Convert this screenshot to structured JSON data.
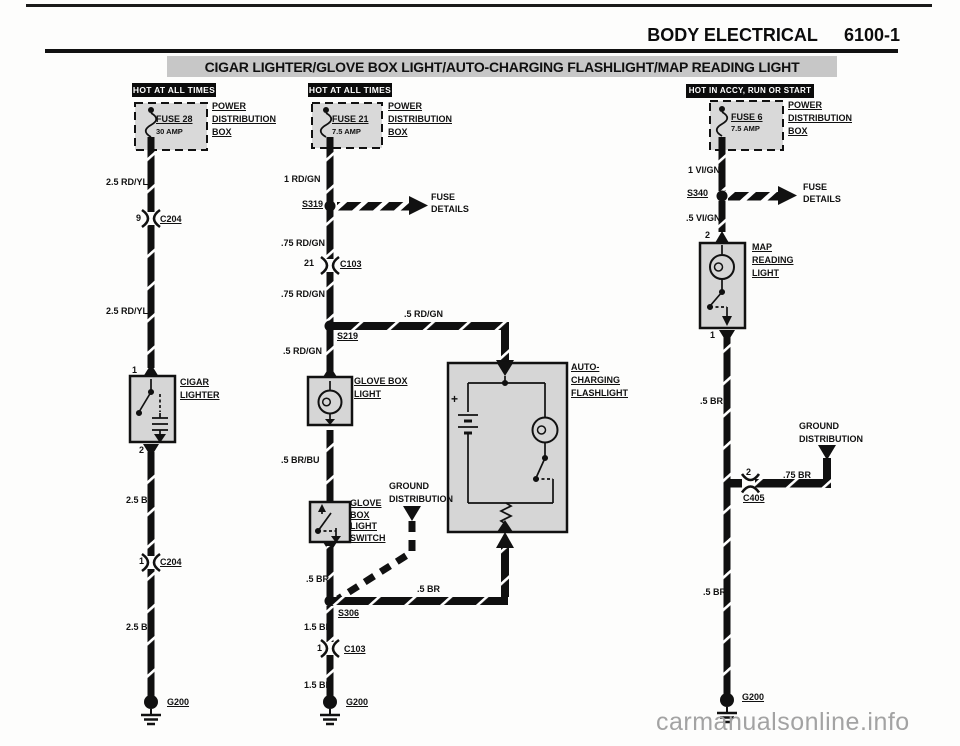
{
  "header": {
    "section": "BODY ELECTRICAL",
    "page": "6100-1"
  },
  "title": "CIGAR LIGHTER/GLOVE BOX LIGHT/AUTO-CHARGING FLASHLIGHT/MAP READING LIGHT",
  "watermark": "carmanualsonline.info",
  "shared": {
    "power_box": [
      "POWER",
      "DISTRIBUTION",
      "BOX"
    ],
    "fuse_details": [
      "FUSE",
      "DETAILS"
    ],
    "ground_distribution": [
      "GROUND",
      "DISTRIBUTION"
    ]
  },
  "col1": {
    "badge": "HOT AT ALL TIMES",
    "fuse_name": "FUSE 28",
    "fuse_rating": "30 AMP",
    "w1": "2.5 RD/YL",
    "c1_pin": "9",
    "c1": "C204",
    "w2": "2.5 RD/YL",
    "pin_top": "1",
    "component": [
      "CIGAR",
      "LIGHTER"
    ],
    "pin_bottom": "2",
    "w3": "2.5 BR",
    "c2_pin": "1",
    "c2": "C204",
    "w4": "2.5 BR",
    "ground": "G200"
  },
  "col2": {
    "badge": "HOT AT ALL TIMES",
    "fuse_name": "FUSE 21",
    "fuse_rating": "7.5 AMP",
    "w1": "1 RD/GN",
    "splice1": "S319",
    "w2": ".75 RD/GN",
    "c1_pin": "21",
    "c1": "C103",
    "w3": ".75 RD/GN",
    "branch_wire": ".5 RD/GN",
    "splice2": "S219",
    "w4": ".5 RD/GN",
    "light": [
      "GLOVE BOX",
      "LIGHT"
    ],
    "w5": ".5 BR/BU",
    "switch": [
      "GLOVE",
      "BOX",
      "LIGHT",
      "SWITCH"
    ],
    "w6": ".5 BR",
    "splice3": "S306",
    "w7": ".5 BR",
    "w8": "1.5 BR",
    "c2_pin": "1",
    "c2": "C103",
    "w9": "1.5 BR",
    "ground": "G200",
    "flashlight": [
      "AUTO-",
      "CHARGING",
      "FLASHLIGHT"
    ],
    "battery_plus": "+"
  },
  "col3": {
    "badge": "HOT IN ACCY, RUN OR START",
    "fuse_name": "FUSE 6",
    "fuse_rating": "7.5 AMP",
    "w1": "1 VI/GN",
    "splice1": "S340",
    "w2": ".5 VI/GN",
    "pin_top": "2",
    "component": [
      "MAP",
      "READING",
      "LIGHT"
    ],
    "pin_bottom": "1",
    "w3": ".5 BR",
    "c1_pin": "2",
    "c1": "C405",
    "branch_wire": ".75 BR",
    "w4": ".5 BR",
    "ground": "G200"
  }
}
